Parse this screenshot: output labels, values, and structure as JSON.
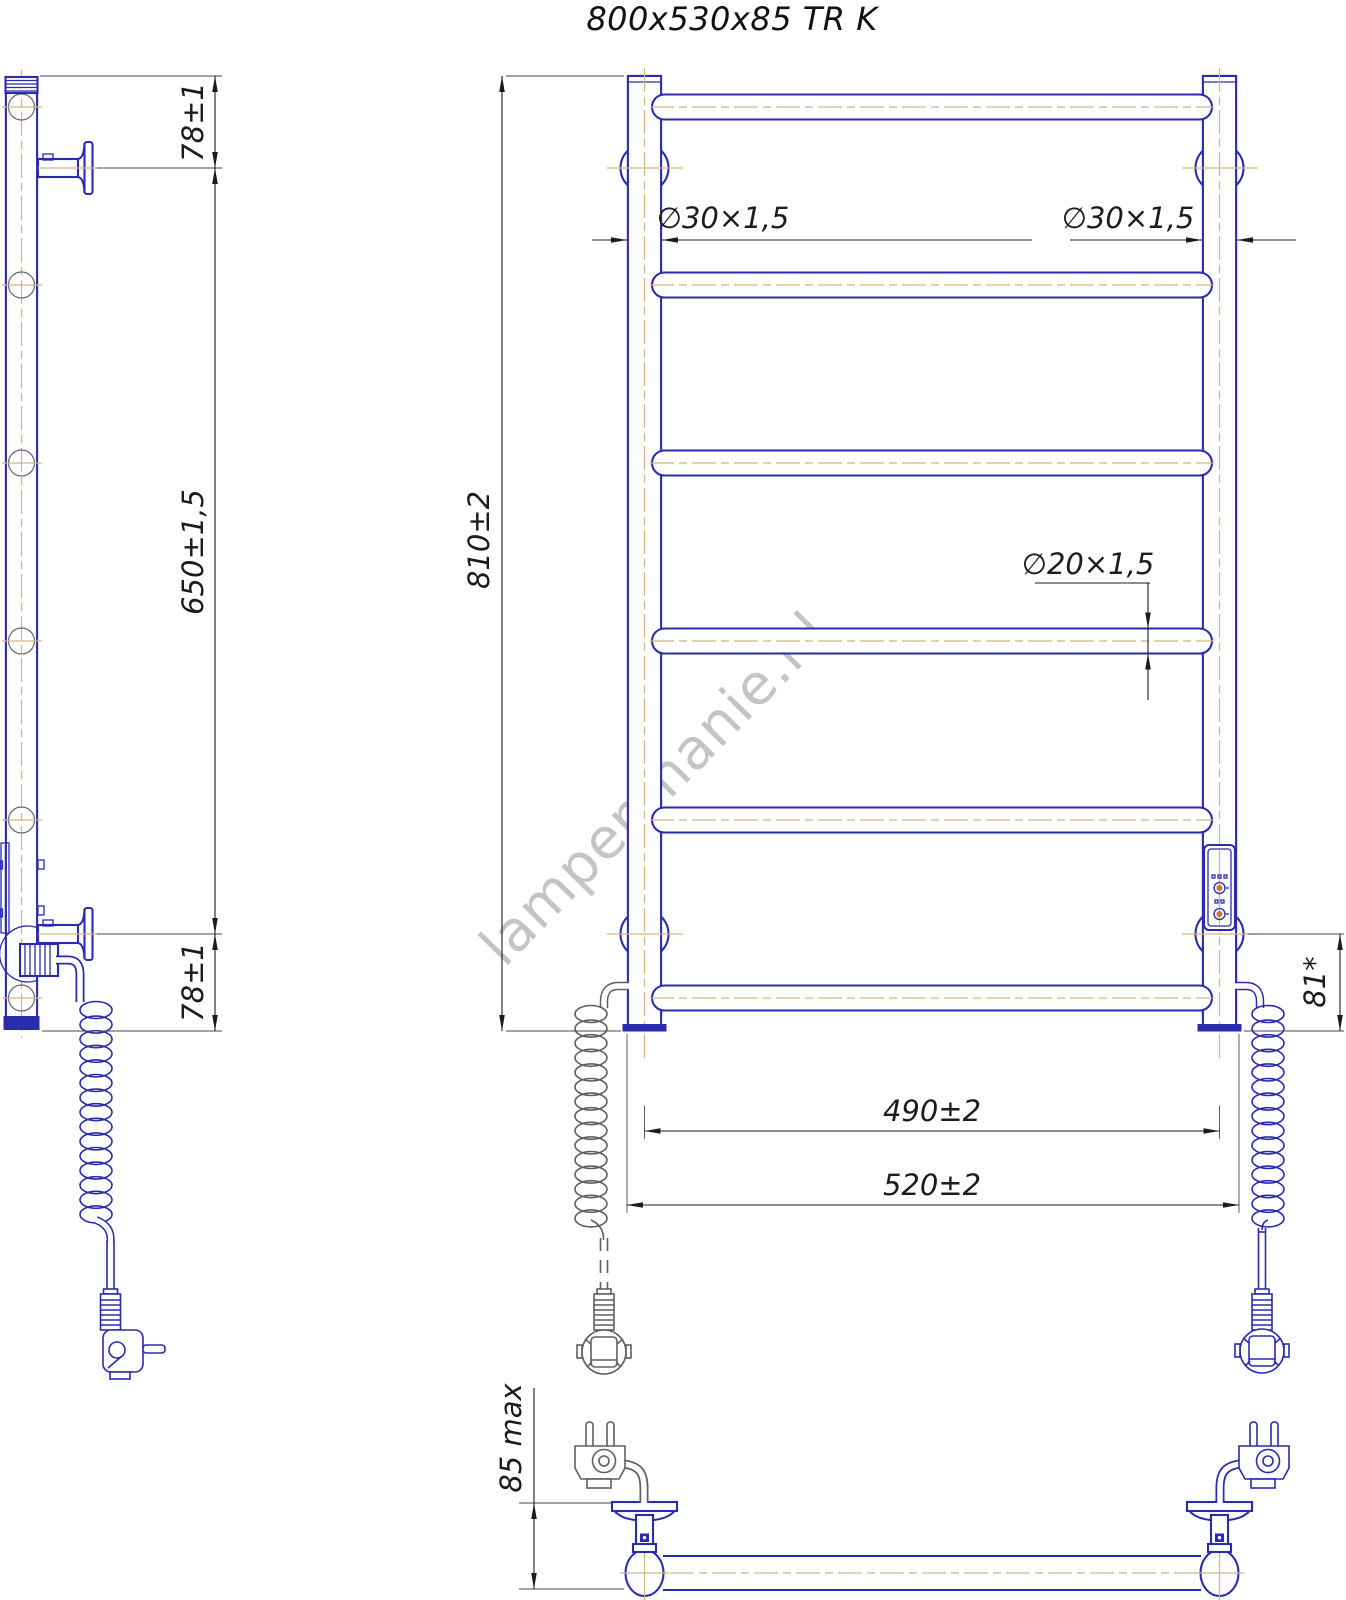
{
  "title": "800x530x85 TR K",
  "watermark": "lampenmanie.nl",
  "dimensions": {
    "side_top": "78±1",
    "side_height": "650±1,5",
    "side_bottom": "78±1",
    "front_height": "810±2",
    "collector_left": "∅30×1,5",
    "collector_right": "∅30×1,5",
    "rung": "∅20×1,5",
    "span_centers": "490±2",
    "span_outer": "520±2",
    "bracket_offset": "81*",
    "depth": "85 max"
  },
  "colors": {
    "outline": "#2b2bad",
    "centerline": "#d3b483",
    "dimension": "#1c1c1c",
    "secondary_gray": "#5f5f5f",
    "watermark": "#c4c4c4",
    "accent": "#c87832"
  }
}
